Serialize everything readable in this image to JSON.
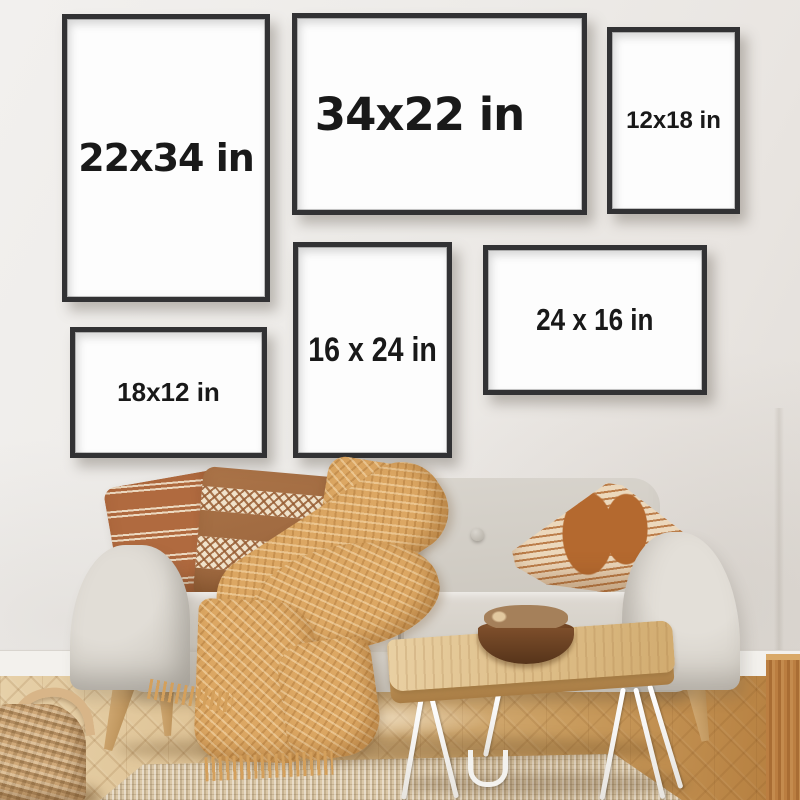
{
  "scene": {
    "description": "Living-room wall mockup showing six black poster frames with print sizes above a grey sofa",
    "frames": [
      {
        "label": "22x34 in"
      },
      {
        "label": "34x22 in"
      },
      {
        "label": "12x18 in"
      },
      {
        "label": "16 x 24 in"
      },
      {
        "label": "24 x 16 in"
      },
      {
        "label": "18x12 in"
      }
    ],
    "palette": {
      "wall": "#edebe8",
      "frame_border": "#323234",
      "frame_paper": "#fdfdfd",
      "label_text": "#191919",
      "sofa_fabric": "#d5d1c9",
      "pillow_rust": "#b06a3f",
      "pillow_brown": "#a06a40",
      "pillow_cream": "#ecd8bc",
      "blanket_mustard": "#dca763",
      "table_wood": "#ddbd87",
      "floor_light": "#e6d0a8",
      "floor_dark": "#b47c3c",
      "rug_jute": "#dac7a7",
      "basket_wicker": "#cfa878"
    }
  }
}
